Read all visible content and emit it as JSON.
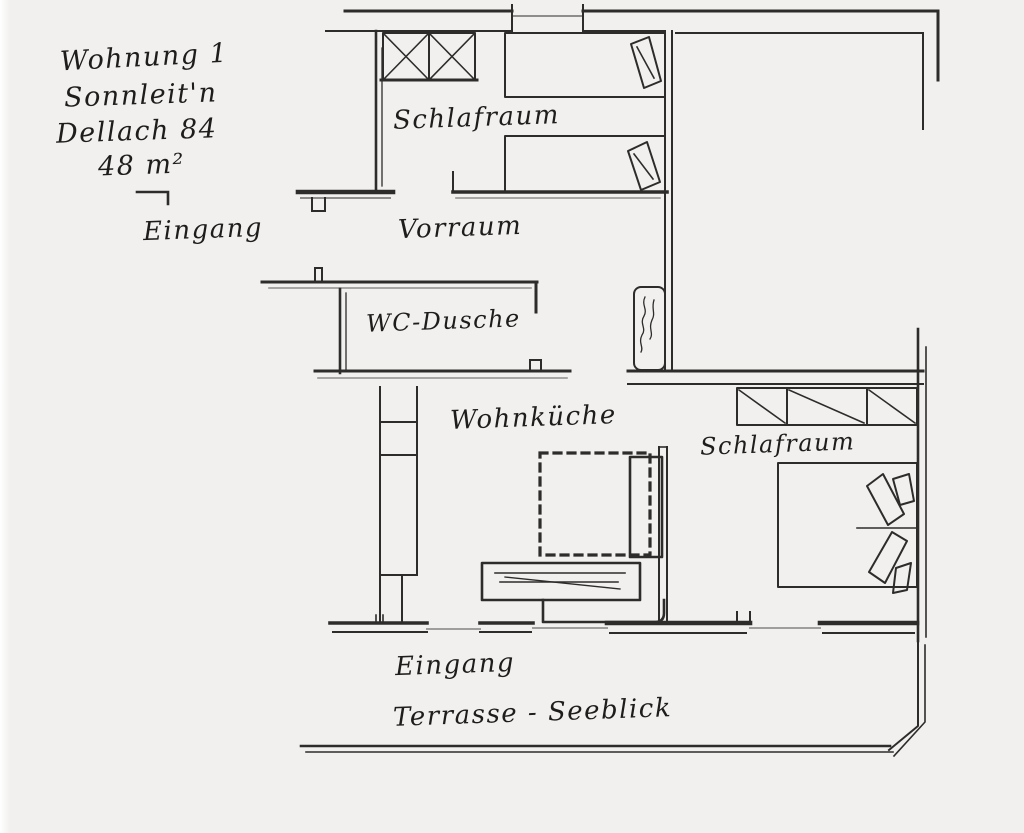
{
  "meta": {
    "document_type": "hand-drawn apartment floor plan (scanned sketch)",
    "ink_color": "#2e2c2a",
    "paper_color": "#f1f0ee"
  },
  "title_block": {
    "apartment": "Wohnung 1",
    "house_name": "Sonnleit'n",
    "address": "Dellach 84",
    "area": "48 m²"
  },
  "rooms": {
    "bedroom_top": "Schlafraum",
    "hallway": "Vorraum",
    "bathroom": "WC-Dusche",
    "kitchen": "Wohnküche",
    "bedroom_right": "Schlafraum"
  },
  "annotations": {
    "entrance_top": "Eingang",
    "entrance_bottom": "Eingang",
    "terrace": "Terrasse - Seeblick"
  }
}
